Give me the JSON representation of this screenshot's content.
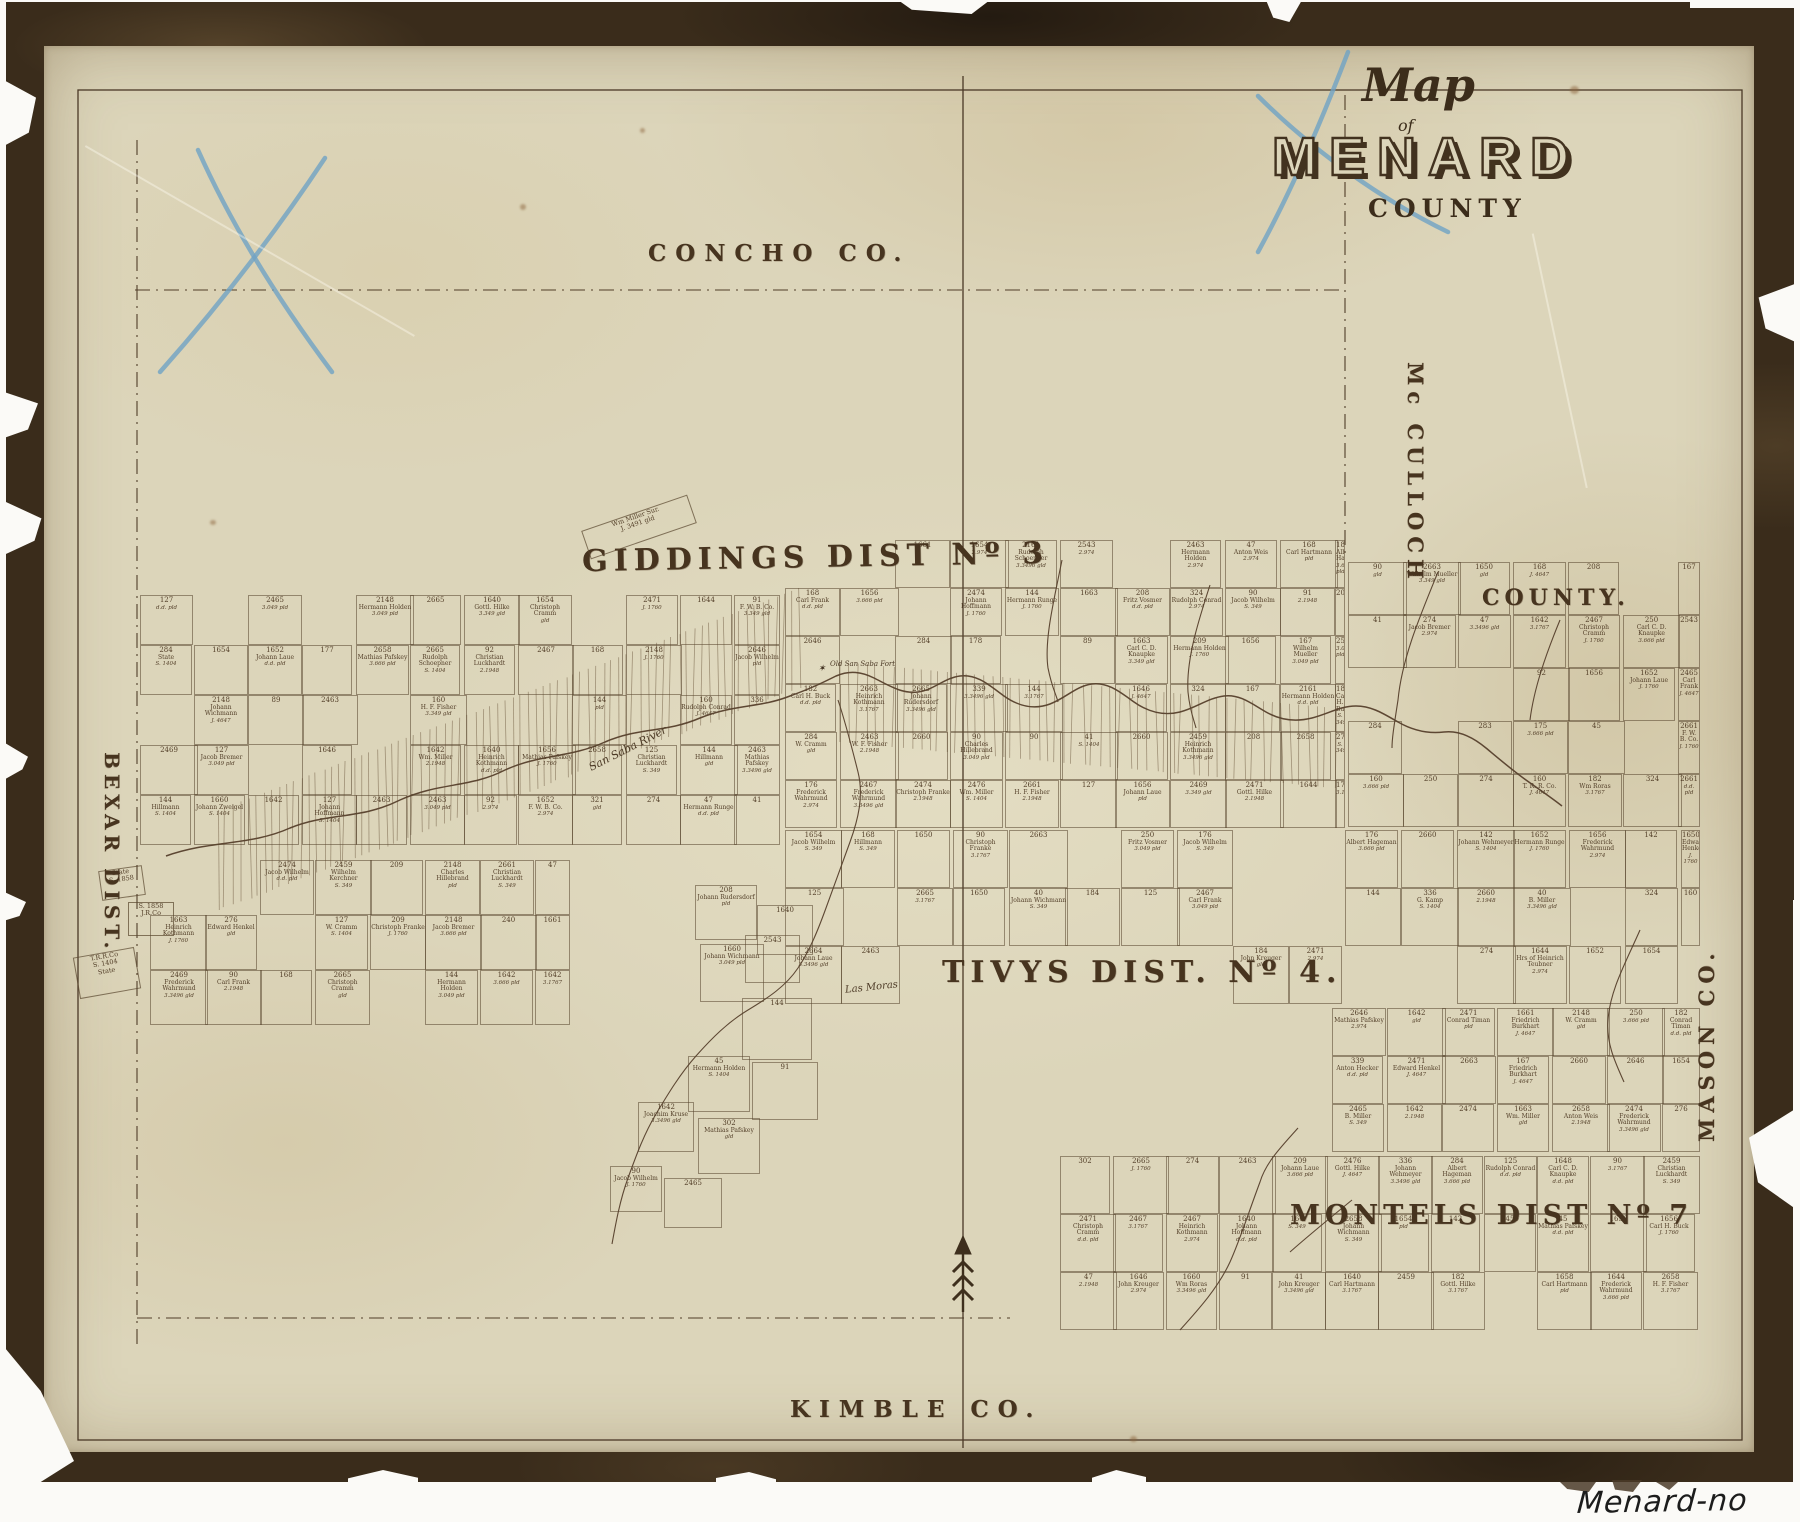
{
  "title_block": {
    "word_map": "Map",
    "word_of": "of",
    "name": "MENARD",
    "word_county": "COUNTY"
  },
  "neighbors": {
    "north": "CONCHO CO.",
    "east_top_1": "Mc CULLOCH",
    "east_top_2": "COUNTY.",
    "east_bottom": "MASON CO.",
    "west": "BEXAR DIST.",
    "south": "KIMBLE CO."
  },
  "districts": {
    "giddings": "GIDDINGS DIST Nº 3",
    "tivys": "TIVYS DIST. Nº 4.",
    "montels": "MONTELS DIST Nº 7"
  },
  "features": {
    "river": "San Saba River",
    "creek": "Las Moras",
    "fort": "Old San Saba Fort",
    "fort_star": "✶",
    "slant_note_line1": "Wm Miller Sur.",
    "slant_note_line2": "J. 3491 gld"
  },
  "annotation": "Menard-no date",
  "colors": {
    "paper": "#dcd5ba",
    "ink": "#4a3826",
    "frame": "#3a2c1b",
    "pencil_blue": "#6fa3c4"
  },
  "plots": {
    "numbers_pool": [
      "2660",
      "2663",
      "2658",
      "2646",
      "2661",
      "2664",
      "2665",
      "2459",
      "2465",
      "2467",
      "2469",
      "2471",
      "2474",
      "2476",
      "2161",
      "2463",
      "2543",
      "2148",
      "1640",
      "1642",
      "1644",
      "1646",
      "1648",
      "1650",
      "1652",
      "1654",
      "1656",
      "1658",
      "1660",
      "1661",
      "1663",
      "176",
      "177",
      "178",
      "168",
      "167",
      "184",
      "182",
      "240",
      "274",
      "276",
      "321",
      "324",
      "209",
      "208",
      "339",
      "302",
      "336",
      "283",
      "284",
      "250",
      "253",
      "125",
      "127",
      "142",
      "144",
      "89",
      "90",
      "91",
      "92",
      "40",
      "41",
      "45",
      "47",
      "158",
      "160",
      "173",
      "175"
    ],
    "names_pool": [
      "Carl Frank",
      "Johann Rudersdorf",
      "Albert Hageman",
      "Friedrich Burkhart",
      "Hrs of Heinrich Teubner",
      "Wilhelm Mueller",
      "H. F. Fisher",
      "B. Miller",
      "Hillmann",
      "Mathias Pafskey",
      "Peter Ludke",
      "Johann Laue",
      "Heinrich Voges",
      "Anton Weis",
      "Conrad Timan",
      "Carl C. D. Knaupke",
      "Johann Wichmann",
      "Christian Luckhardt",
      "Christoph Cramm",
      "T. R. R. Co.",
      "State",
      "Carl Hartmann",
      "Gottl. Hilke",
      "Wm Roras",
      "Johann Zweigel",
      "Jacob Wilhelm",
      "Hermann Holden",
      "Rudolph Schoepner",
      "John Kreuger",
      "Wilhelm Kerchner",
      "Heinrich Kothmann",
      "Adolph Michaelis",
      "Johann Hoffmann",
      "Anton Hecker",
      "Georg Frisch",
      "Fritz Aurand",
      "Edward Henkel",
      "Johann Wehmeyer",
      "W. Cramm",
      "Rudolph Conrad",
      "Christoph Franke",
      "Joachim Kruse",
      "G. Kamp",
      "Charles Hillebrand",
      "F. W. B. Co.",
      "Wm. Miller",
      "W. F. Fisher",
      "Fritz Vosmer",
      "Carl H. Buck",
      "Jacob Bremer",
      "Hermann Runge",
      "Frederick Wahrmund"
    ],
    "values_pool": [
      "3.349 gld",
      "3.3496 gld",
      "S. 1404",
      "J. 1760",
      "2.974",
      "3.049 pld",
      "3.1767",
      "2.1948",
      "3.666 pld",
      "pld",
      "gld",
      "S. 349",
      "J. 4647",
      "d.d. pld"
    ],
    "regions": [
      {
        "x": 140,
        "y": 595,
        "w": 640,
        "h": 250,
        "cw": 54,
        "ch": 50,
        "density": 0.88
      },
      {
        "x": 785,
        "y": 540,
        "w": 560,
        "h": 290,
        "cw": 55,
        "ch": 48,
        "density": 0.9
      },
      {
        "x": 1348,
        "y": 562,
        "w": 352,
        "h": 266,
        "cw": 55,
        "ch": 53,
        "density": 0.9
      },
      {
        "x": 785,
        "y": 830,
        "w": 915,
        "h": 178,
        "cw": 56,
        "ch": 58,
        "density": 0.85
      },
      {
        "x": 1332,
        "y": 1008,
        "w": 368,
        "h": 146,
        "cw": 55,
        "ch": 48,
        "density": 0.85
      },
      {
        "x": 150,
        "y": 860,
        "w": 420,
        "h": 166,
        "cw": 55,
        "ch": 55,
        "density": 0.8
      },
      {
        "x": 1060,
        "y": 1156,
        "w": 640,
        "h": 178,
        "cw": 53,
        "ch": 58,
        "density": 0.9
      }
    ],
    "avoid": [
      {
        "x": 570,
        "y": 532,
        "w": 340,
        "h": 52
      },
      {
        "x": 920,
        "y": 945,
        "w": 310,
        "h": 58
      }
    ],
    "extra_cells": [
      [
        695,
        885,
        62,
        55
      ],
      [
        757,
        905,
        56,
        50
      ],
      [
        700,
        944,
        64,
        58
      ],
      [
        742,
        998,
        70,
        62
      ],
      [
        688,
        1056,
        62,
        56
      ],
      [
        752,
        1062,
        66,
        58
      ],
      [
        638,
        1102,
        56,
        50
      ],
      [
        698,
        1118,
        62,
        56
      ],
      [
        610,
        1166,
        52,
        46
      ],
      [
        664,
        1178,
        58,
        50
      ],
      [
        745,
        935,
        55,
        48
      ]
    ],
    "special_cells": [
      {
        "x": 100,
        "y": 868,
        "w": 44,
        "h": 30,
        "rot": -8,
        "lines": [
          "State",
          "S. 1858"
        ]
      },
      {
        "x": 76,
        "y": 952,
        "w": 62,
        "h": 42,
        "rot": -10,
        "lines": [
          "T.R.R.Co",
          "S. 1404",
          "State"
        ]
      },
      {
        "x": 128,
        "y": 902,
        "w": 46,
        "h": 34,
        "rot": 0,
        "lines": [
          "S. 1858",
          "J.R.Co"
        ]
      }
    ],
    "belts": [
      {
        "x1": 800,
        "y1": 638,
        "x2": 218,
        "y2": 860,
        "hw": 50,
        "gap": 8
      },
      {
        "x1": 840,
        "y1": 702,
        "x2": 1335,
        "y2": 748,
        "hw": 40,
        "gap": 9
      }
    ]
  }
}
